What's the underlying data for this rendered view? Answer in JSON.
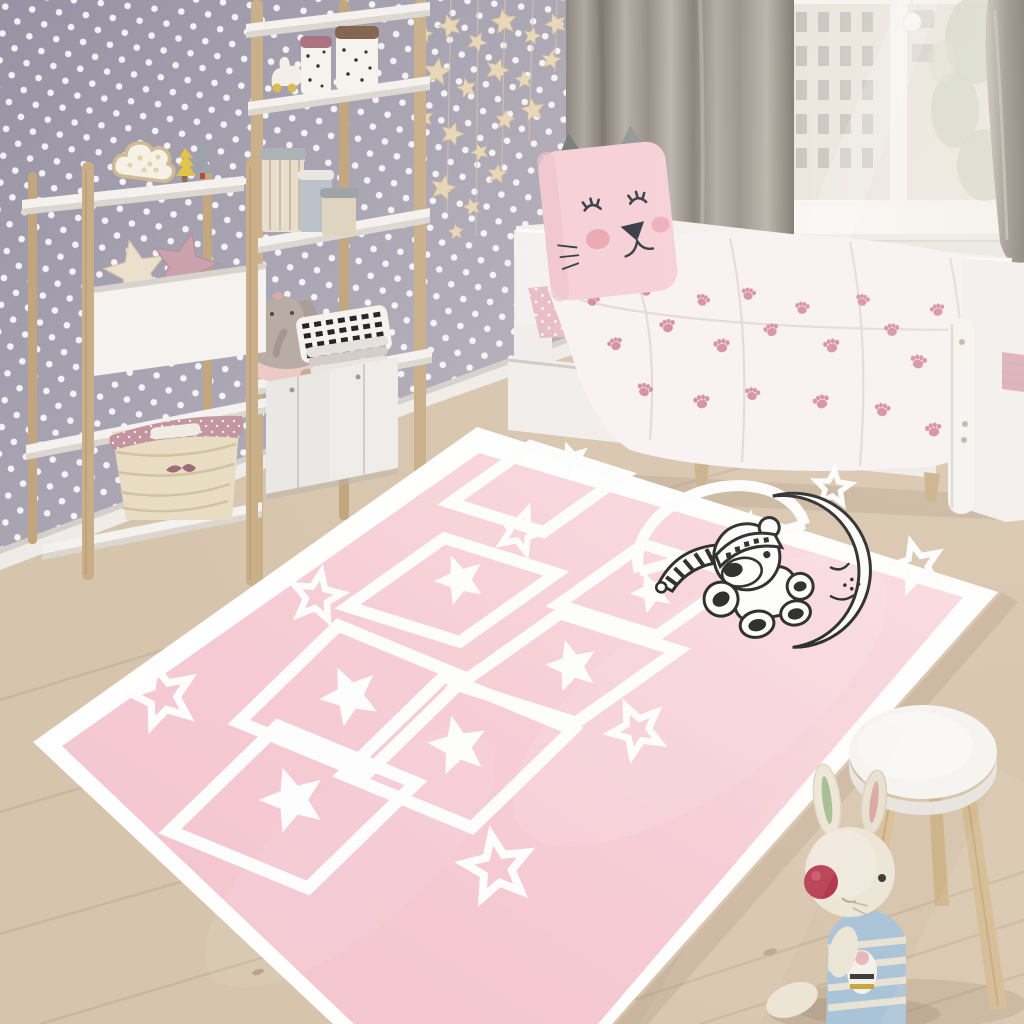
{
  "scene": {
    "description": "Children's bedroom with pink hopscotch play rug, polka-dot wallpaper, white ladder shelves with toys, white daybed with cat pillow and paw-print duvet, window with grey curtains, wooden stool and plush bunny",
    "style": "photorealistic room render"
  },
  "palette": {
    "wall_base": "#a49fae",
    "wall_base_dark": "#938e9e",
    "wall_dot": "#ffffff",
    "baseboard": "#efece8",
    "floor": "#d7c4ad",
    "floor_dark": "#c4ae94",
    "floor_seam": "#ac9579",
    "curtain": "#928c85",
    "curtain_light": "#b3ada5",
    "curtain_dark": "#6f6962",
    "window_frame": "#f2f0ed",
    "building": "#dbd5ca",
    "building_window": "#96908a",
    "foliage": "#a3b08c",
    "shelf_white": "#f4f1ee",
    "pole_wood": "#c9ae87",
    "pole_wood_dark": "#b2946c",
    "cabinet": "#e9e7e4",
    "bed_white": "#f3f0ef",
    "duvet": "#f7f1f3",
    "paw_pink": "#cf8098",
    "sheet_pink": "#e6b9c4",
    "pillow_pink": "#f5cdd6",
    "pillow_ear": "#6e7672",
    "face_ink": "#2a2f3a",
    "cheek_pink": "#e79aa8",
    "rug_pink": "#f5cad3",
    "rug_pink_light": "#fadce2",
    "rug_white": "#ffffff",
    "motif_ink": "#232323",
    "stool_top": "#f6f4f1",
    "stool_leg": "#d8bf97",
    "bunny_cream": "#ece5d6",
    "bunny_stripe": "#a9c3d7",
    "bunny_nose": "#b23349",
    "ear_green": "#9db98a",
    "ear_pink": "#d8a7a4",
    "garland_star": "#e6d5b5",
    "basket": "#e8dcc2",
    "basket_liner": "#c294a0",
    "star_pillow_cream": "#ece0cc",
    "star_pillow_mauve": "#c9a0ac",
    "tree_yellow": "#e3c345",
    "tree_gray": "#9ba1a8",
    "jar_lid_mauve": "#a86f7c",
    "jar_lid_brown": "#7d6049",
    "elephant_gray": "#b7a9a4",
    "elephant_skirt": "#ecc9c4"
  },
  "objects": {
    "wallpaper": {
      "label": "grey polka-dot wallpaper"
    },
    "garland": {
      "label": "hanging wooden star garland",
      "star_count": 20
    },
    "window": {
      "label": "window with city building and foliage outside",
      "panes": 2
    },
    "curtains": {
      "label": "grey curtain panels",
      "count": 2
    },
    "shelf_front": {
      "label": "white ladder shelf with cloud lamp, tree figures, star cushions, wicker basket"
    },
    "shelf_tall": {
      "label": "tall ladder shelf with dotted jars, hat boxes, elephant plush, zigzag pillow, storage cabinets"
    },
    "bed": {
      "label": "white daybed with under-bed drawers",
      "drawers": 2
    },
    "cat_pillow": {
      "label": "pink sleeping-cat pillow with grey ears"
    },
    "duvet": {
      "label": "white duvet with pink paw prints",
      "paw_count": 22
    },
    "rug": {
      "label": "pink hopscotch rug",
      "style": "hopscotch court with stars",
      "court_cells": 7,
      "cell_stars": 5,
      "scattered_solid_stars": 2,
      "scattered_outline_stars": 7,
      "motif": "teddy bear with striped nightcap sleeping on crescent moon"
    },
    "stool": {
      "label": "white round stool with wooden legs",
      "legs": 3
    },
    "bunny": {
      "label": "plush bunny in blue striped shirt with red nose"
    }
  }
}
